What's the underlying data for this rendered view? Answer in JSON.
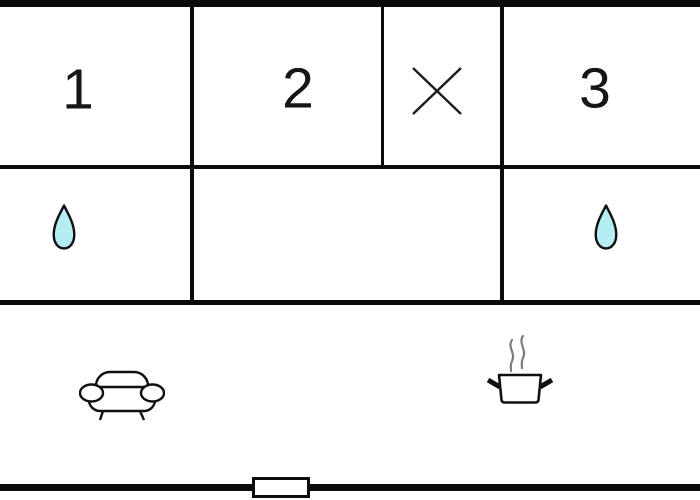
{
  "plan": {
    "type": "floor-plan",
    "background_color": "#ffffff",
    "wall_color": "#0b0b0b",
    "rooms": {
      "room1": {
        "label": "1"
      },
      "room2": {
        "label": "2"
      },
      "room3": {
        "label": "3"
      }
    },
    "symbols": {
      "crossed_cell": "x-marker",
      "bath_left": "water-drop",
      "bath_right": "water-drop",
      "living_area": "sofa",
      "kitchen": "cooking-pot-with-steam",
      "entry": "window-door-marker"
    },
    "colors": {
      "water_drop_fill": "#b5eef2",
      "icon_outline": "#111111",
      "steam": "#7d7d7d",
      "label_color": "#161616"
    }
  }
}
